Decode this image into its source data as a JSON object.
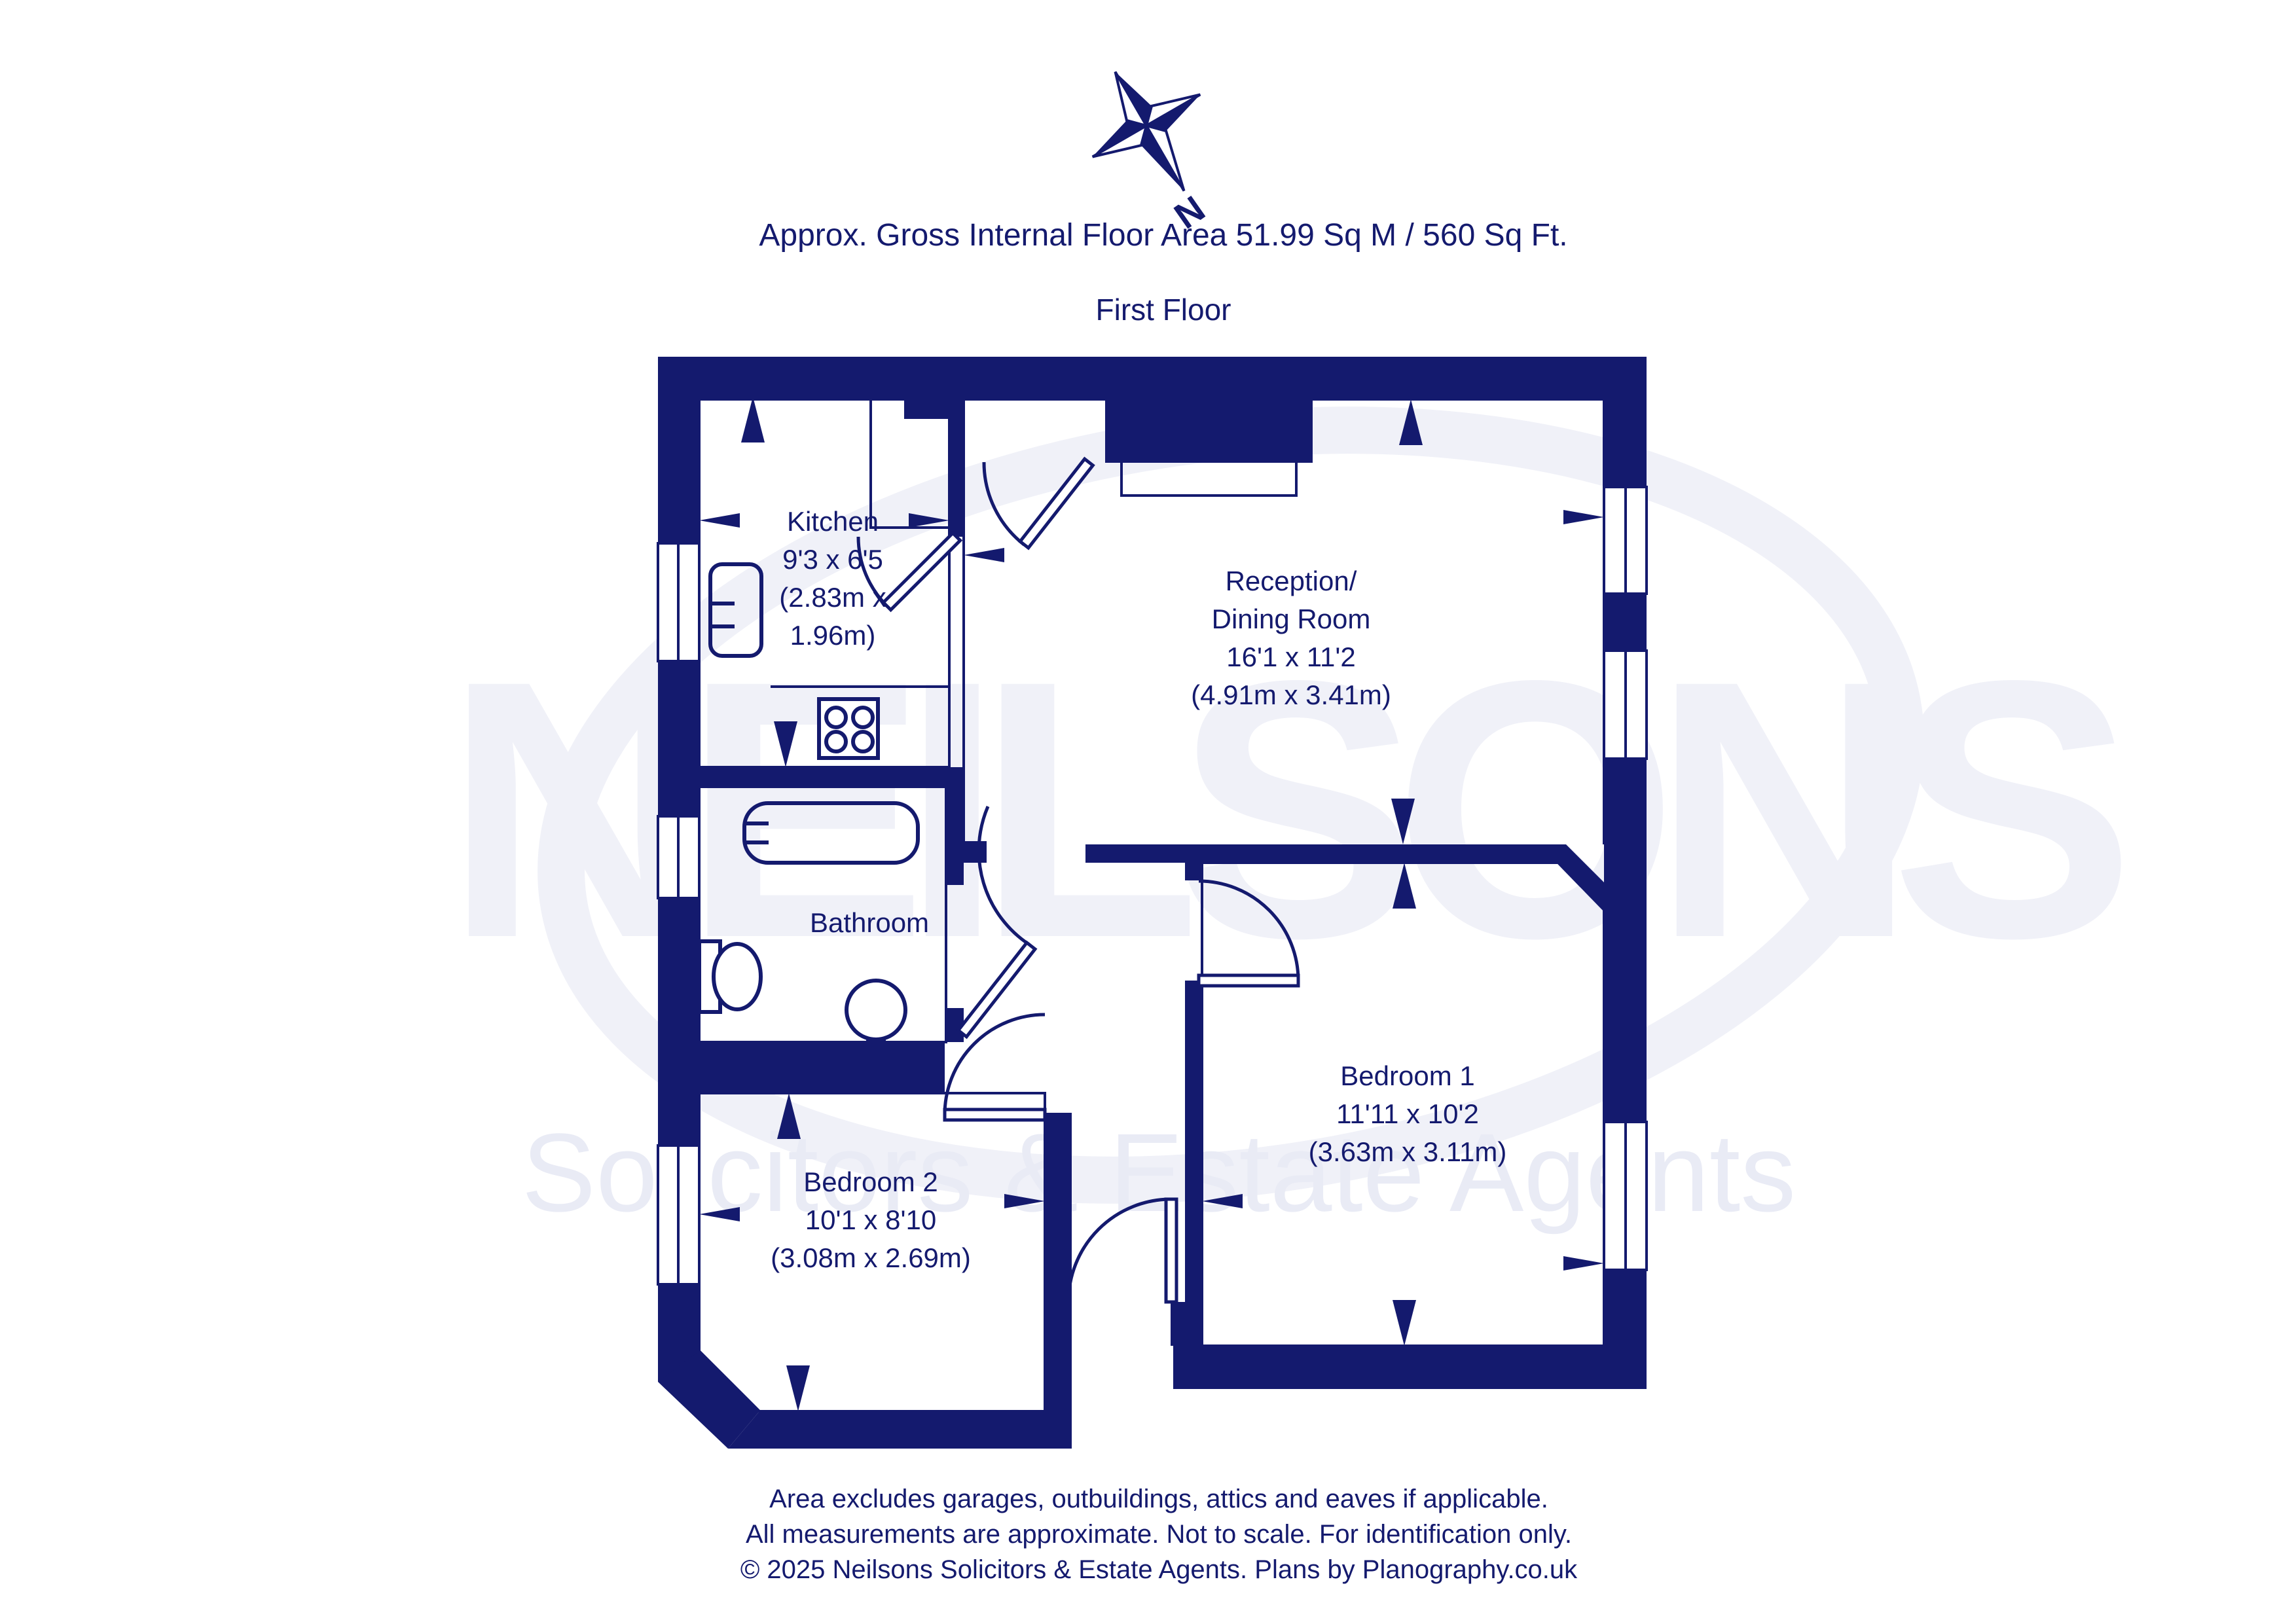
{
  "colors": {
    "navy": "#141a6e",
    "watermark_light": "#f0f1f8",
    "watermark_tagline": "#e9ebf5",
    "room_fill": "#ffffff"
  },
  "header": {
    "area_line": "Approx. Gross Internal Floor Area 51.99 Sq M / 560 Sq Ft.",
    "floor_label": "First Floor",
    "compass_letter": "N"
  },
  "rooms": {
    "kitchen": {
      "label": "Kitchen\n9'3 x 6'5\n(2.83m x\n1.96m)"
    },
    "reception": {
      "label": "Reception/\nDining Room\n16'1 x 11'2\n(4.91m x 3.41m)"
    },
    "bathroom": {
      "label": "Bathroom"
    },
    "bedroom1": {
      "label": "Bedroom 1\n11'11 x 10'2\n(3.63m x 3.11m)"
    },
    "bedroom2": {
      "label": "Bedroom 2\n10'1 x 8'10\n(3.08m x 2.69m)"
    }
  },
  "watermark": {
    "name": "NEILSONS",
    "tagline": "Solicitors & Estate Agents"
  },
  "footer": {
    "line1": "Area excludes garages, outbuildings, attics and eaves if applicable.",
    "line2": "All measurements are approximate. Not to scale. For identification only.",
    "line3": "© 2025 Neilsons Solicitors & Estate Agents. Plans by Planography.co.uk"
  }
}
